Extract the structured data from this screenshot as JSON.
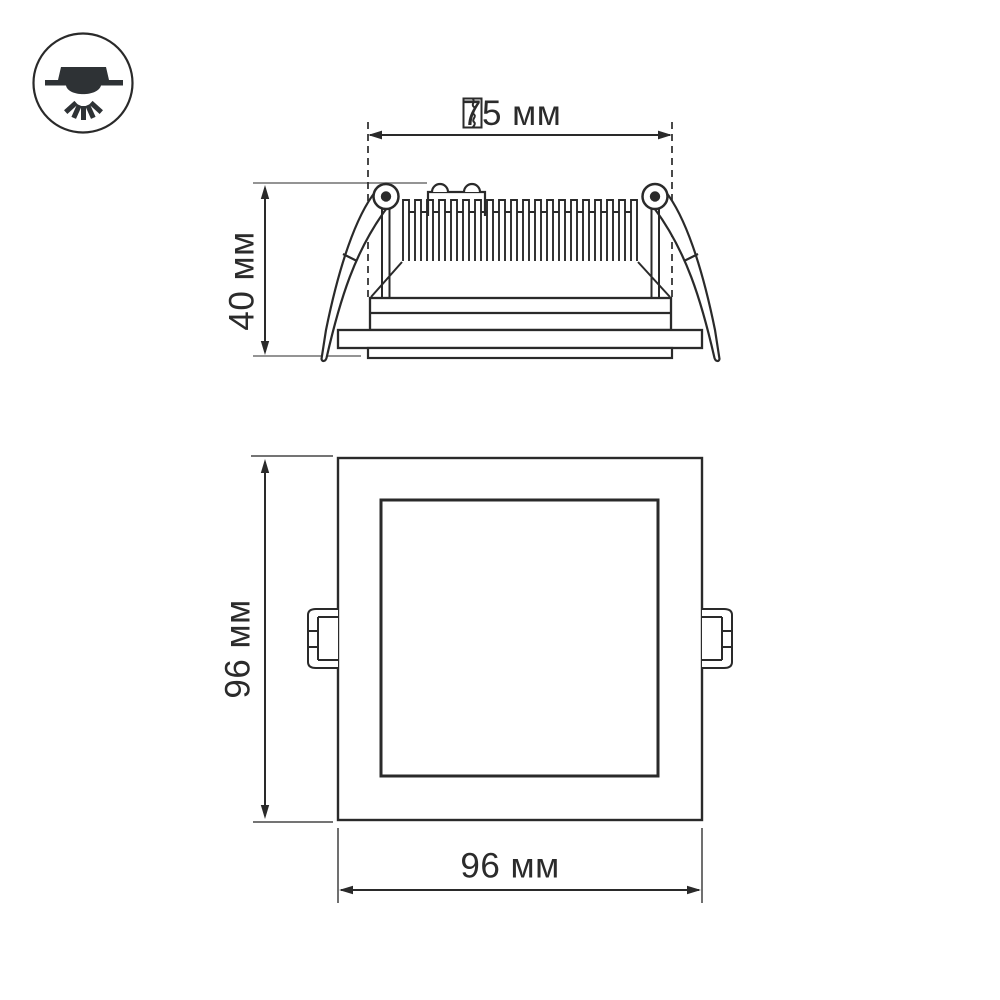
{
  "colors": {
    "background": "#ffffff",
    "ink": "#2a2a2a",
    "extension_line_side": "#949494",
    "extension_line_front": "#606060",
    "icon_fill": "#2e3235"
  },
  "corner_badge": {
    "icon": "recessed-downlight-icon"
  },
  "labels": {
    "cutout_width": "75 мм",
    "cutout_icon": "cutout-hole-icon",
    "fixture_height": "40 мм",
    "panel_height": "96 мм",
    "panel_width": "96 мм"
  }
}
